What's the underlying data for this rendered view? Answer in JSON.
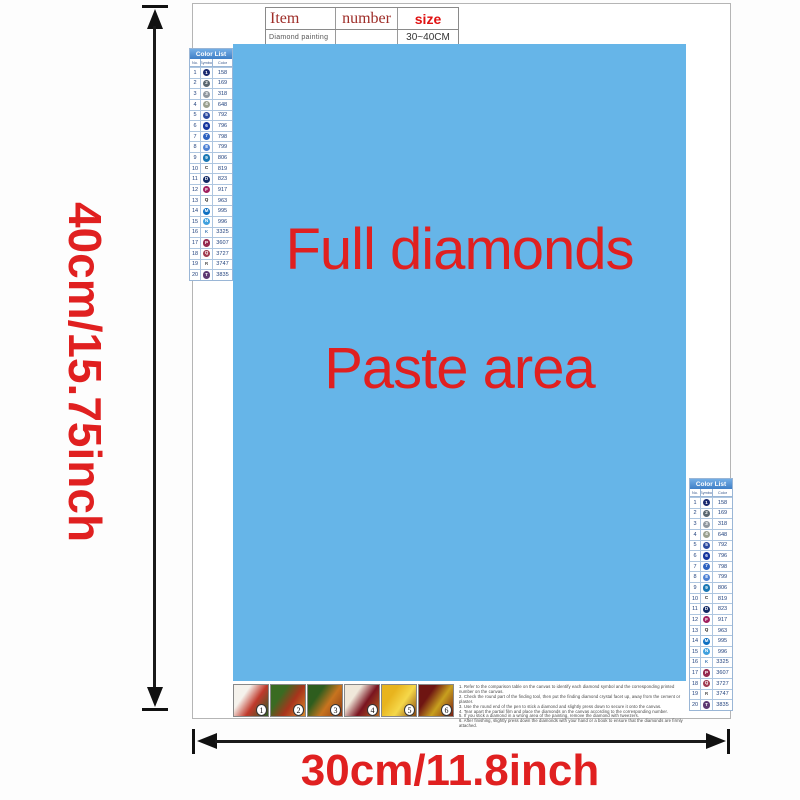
{
  "colors": {
    "paste_area_bg": "#66b5e8",
    "accent_red": "#e02020",
    "table_header_red": "#9e2d28",
    "size_red": "#e01212",
    "list_header_bg": "#4f92d2"
  },
  "dimensions": {
    "height_label": "40cm/15.75inch",
    "width_label": "30cm/11.8inch"
  },
  "paste_area": {
    "line1": "Full diamonds",
    "line2": "Paste area"
  },
  "spec_table": {
    "headers": [
      "Item",
      "number",
      "size"
    ],
    "row": {
      "item": "Diamond painting",
      "number": "",
      "size": "30~40CM"
    }
  },
  "color_list": {
    "title": "Color List",
    "columns": [
      "No.",
      "Symbol",
      "Color"
    ],
    "rows": [
      {
        "no": "1",
        "symbol": "1",
        "sym_bg": "#1b2a70",
        "sym_fg": "#ffffff",
        "code": "158"
      },
      {
        "no": "2",
        "symbol": "2",
        "sym_bg": "#5a6770",
        "sym_fg": "#ffffff",
        "code": "169"
      },
      {
        "no": "3",
        "symbol": "3",
        "sym_bg": "#8f979e",
        "sym_fg": "#ffffff",
        "code": "318"
      },
      {
        "no": "4",
        "symbol": "4",
        "sym_bg": "#9aa08f",
        "sym_fg": "#ffffff",
        "code": "648"
      },
      {
        "no": "5",
        "symbol": "5",
        "sym_bg": "#2c4ba0",
        "sym_fg": "#ffffff",
        "code": "792"
      },
      {
        "no": "6",
        "symbol": "6",
        "sym_bg": "#16369e",
        "sym_fg": "#ffffff",
        "code": "796"
      },
      {
        "no": "7",
        "symbol": "7",
        "sym_bg": "#2d62c0",
        "sym_fg": "#ffffff",
        "code": "798"
      },
      {
        "no": "8",
        "symbol": "8",
        "sym_bg": "#4f82d4",
        "sym_fg": "#ffffff",
        "code": "799"
      },
      {
        "no": "9",
        "symbol": "9",
        "sym_bg": "#1a78b4",
        "sym_fg": "#ffffff",
        "code": "806"
      },
      {
        "no": "10",
        "symbol": "C",
        "sym_bg": "transparent",
        "sym_fg": "#222222",
        "code": "819"
      },
      {
        "no": "11",
        "symbol": "D",
        "sym_bg": "#122a66",
        "sym_fg": "#ffffff",
        "code": "823"
      },
      {
        "no": "12",
        "symbol": "F",
        "sym_bg": "#a02060",
        "sym_fg": "#ffffff",
        "code": "917"
      },
      {
        "no": "13",
        "symbol": "Q",
        "sym_bg": "transparent",
        "sym_fg": "#222222",
        "code": "963"
      },
      {
        "no": "14",
        "symbol": "M",
        "sym_bg": "#0d6fc2",
        "sym_fg": "#ffffff",
        "code": "995"
      },
      {
        "no": "15",
        "symbol": "N",
        "sym_bg": "#3fa0de",
        "sym_fg": "#ffffff",
        "code": "996"
      },
      {
        "no": "16",
        "symbol": "K",
        "sym_bg": "transparent",
        "sym_fg": "#4a80b8",
        "code": "3325"
      },
      {
        "no": "17",
        "symbol": "P",
        "sym_bg": "#962a4e",
        "sym_fg": "#ffffff",
        "code": "3607"
      },
      {
        "no": "18",
        "symbol": "Q",
        "sym_bg": "#a03a50",
        "sym_fg": "#ffffff",
        "code": "3727"
      },
      {
        "no": "19",
        "symbol": "R",
        "sym_bg": "transparent",
        "sym_fg": "#555555",
        "code": "3747"
      },
      {
        "no": "20",
        "symbol": "T",
        "sym_bg": "#5e3a72",
        "sym_fg": "#ffffff",
        "code": "3835"
      }
    ]
  },
  "steps": {
    "tiles": [
      {
        "num": "1",
        "c1": "#f5f2ec",
        "c2": "#c0392b",
        "c3": "#2e5d24"
      },
      {
        "num": "2",
        "c1": "#3a6b22",
        "c2": "#a8341c",
        "c3": "#d98a2b"
      },
      {
        "num": "3",
        "c1": "#2e5d1e",
        "c2": "#c8741f",
        "c3": "#8a3a14"
      },
      {
        "num": "4",
        "c1": "#f0e8da",
        "c2": "#7a1420",
        "c3": "#b5651d"
      },
      {
        "num": "5",
        "c1": "#e8b41e",
        "c2": "#f5d84a",
        "c3": "#8a4a10"
      },
      {
        "num": "6",
        "c1": "#6e1512",
        "c2": "#c8a01e",
        "c3": "#7a1f14"
      }
    ]
  },
  "instructions": {
    "lines": [
      "1. Refer to the comparison table on the canvas to identify each diamond symbol and the corresponding printed number on the canvas.",
      "2. Check the round part of the finding tool, then put the finding diamond crystal facet up, away from the cement or plaster.",
      "3. Use the round end of the pen to stick a diamond and slightly press down to secure it onto the canvas.",
      "4. Tear apart the partial film and place the diamonds on the canvas according to the corresponding number.",
      "5. If you stick a diamond in a wrong area of the painting, remove the diamond with tweezers.",
      "6. After finishing, slightly press down the diamonds with your hand or a book to ensure that the diamonds are firmly attached."
    ]
  }
}
